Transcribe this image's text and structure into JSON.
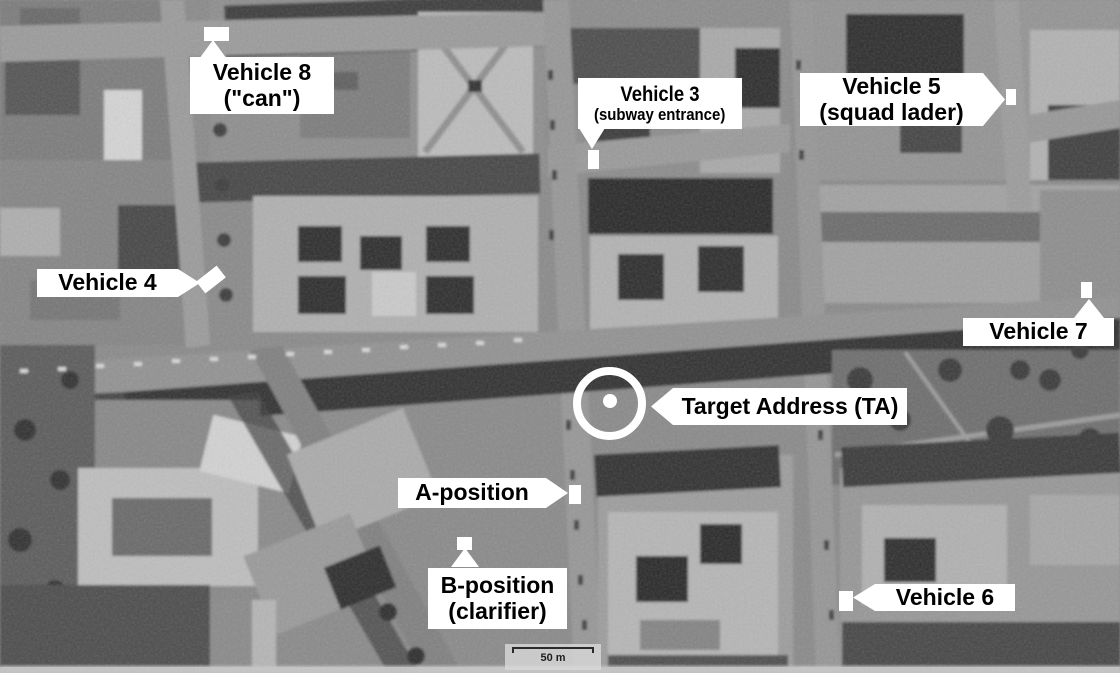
{
  "colors": {
    "callout_bg": "#ffffff",
    "callout_text": "#000000",
    "marker_color": "#ffffff",
    "ring_color": "#ffffff"
  },
  "annotations": {
    "vehicle8": {
      "line1": "Vehicle 8",
      "line2": "(\"can\")"
    },
    "vehicle3": {
      "line1": "Vehicle 3",
      "line2": "(subway entrance)"
    },
    "vehicle5": {
      "line1": "Vehicle 5",
      "line2": "(squad lader)"
    },
    "vehicle4": {
      "label": "Vehicle 4"
    },
    "vehicle7": {
      "label": "Vehicle 7"
    },
    "target_address": {
      "label": "Target Address (TA)"
    },
    "a_position": {
      "label": "A-position"
    },
    "b_position": {
      "line1": "B-position",
      "line2": "(clarifier)"
    },
    "vehicle6": {
      "label": "Vehicle 6"
    },
    "scale_bar": {
      "label": "50 m"
    }
  }
}
